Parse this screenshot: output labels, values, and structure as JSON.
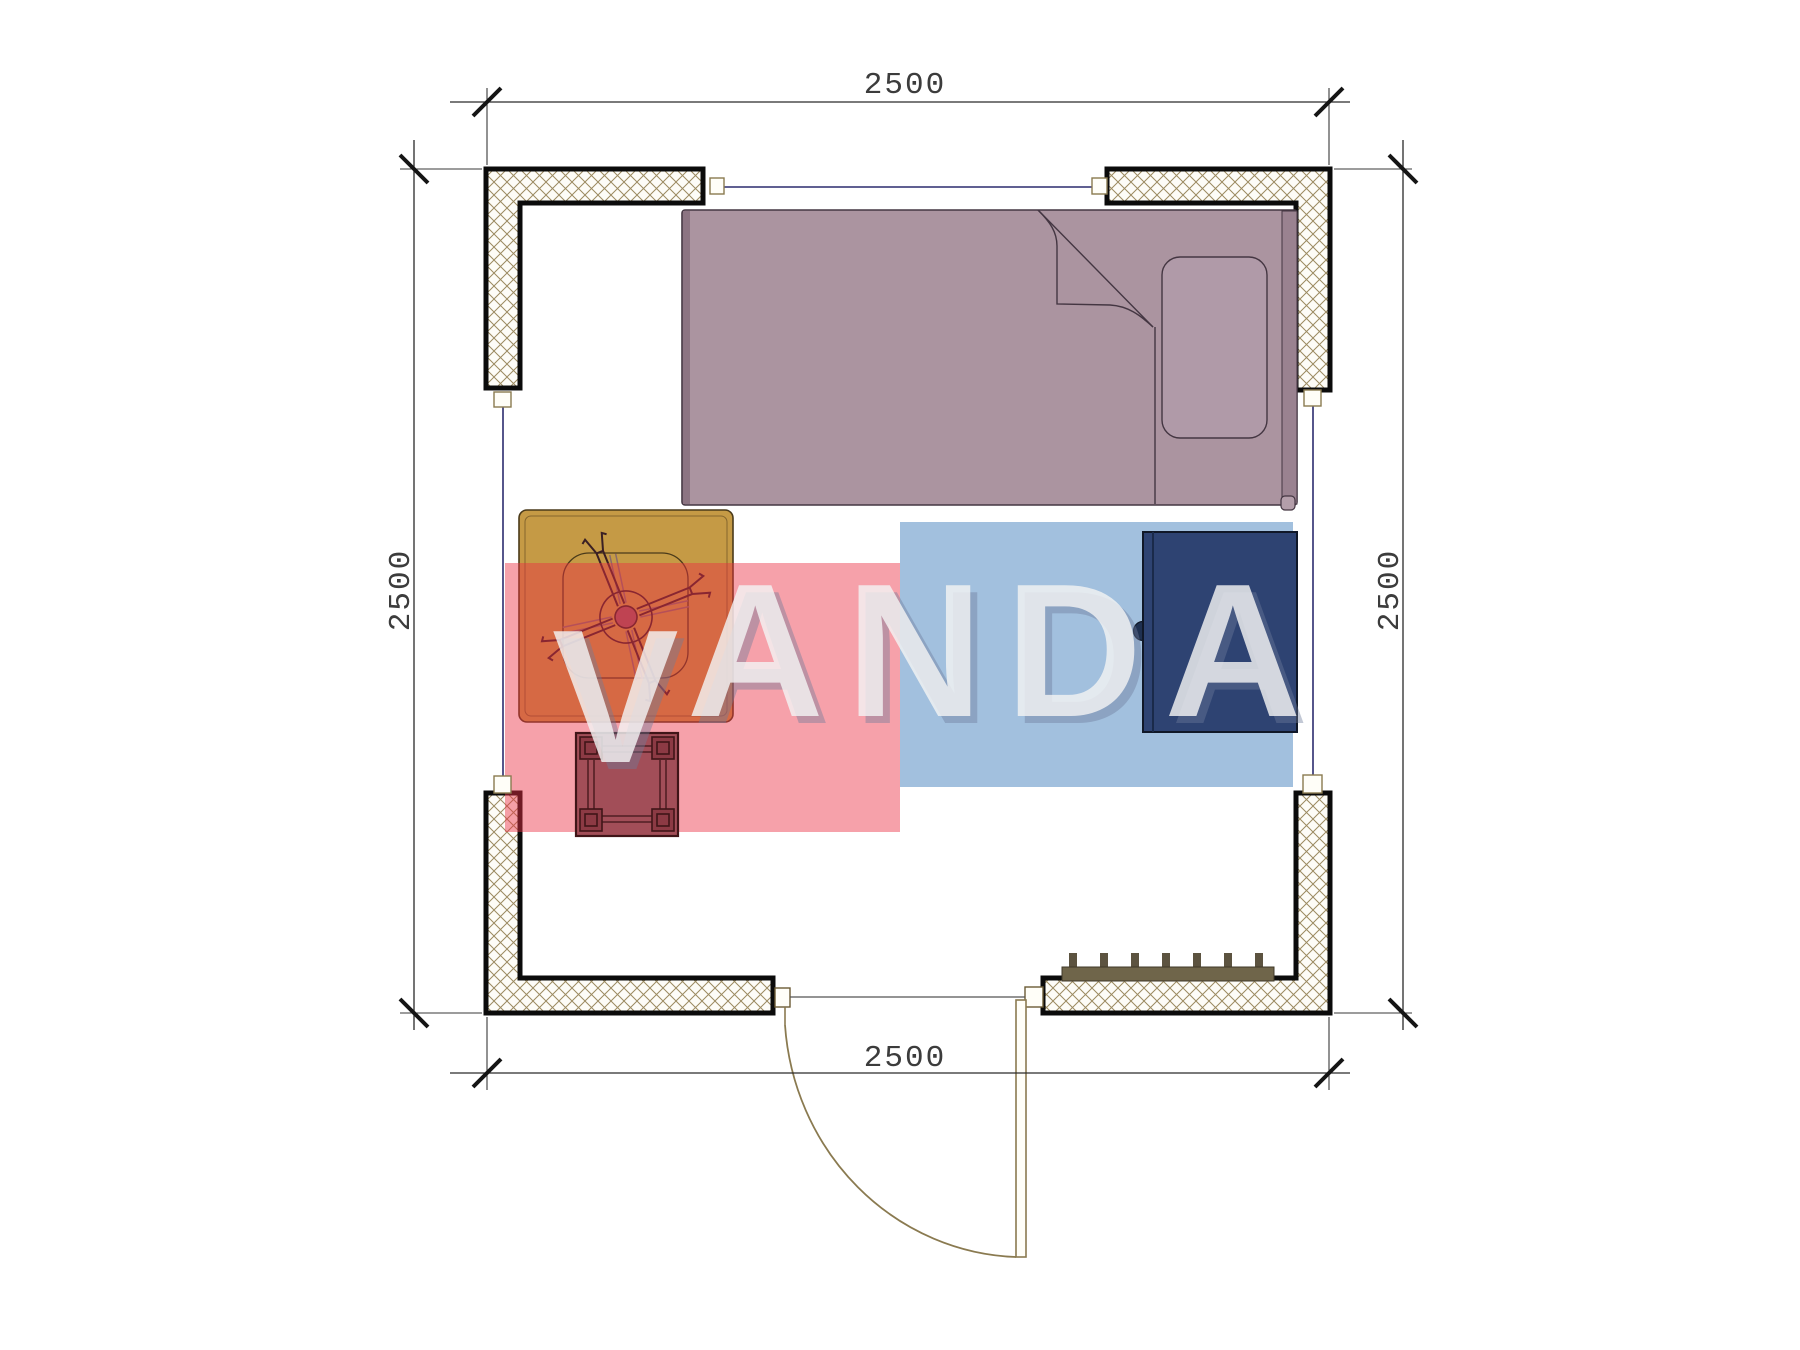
{
  "page": {
    "background": "#ffffff"
  },
  "plan": {
    "dimension_top": "2500",
    "dimension_bottom": "2500",
    "dimension_left": "2500",
    "dimension_right": "2500"
  },
  "watermark": {
    "letter_v": "V",
    "letters_rest": "ANDA",
    "letter_color": "rgba(243,243,243,0.82)",
    "letter_shadow_color": "rgba(110,125,155,0.42)",
    "red_block_color": "rgba(236,47,66,0.45)",
    "blue_block_color": "rgba(100,150,200,0.60)"
  },
  "furniture": {
    "bed_color": "#ab94a0",
    "bed_trim_color": "#8c7482",
    "bed_headboard_color": "#9a8290",
    "pillow_color": "#b09aa8",
    "table_color": "#c59a45",
    "stool_color": "#a24e58",
    "stool_post_color": "#8c3a44",
    "wardrobe_color": "#2e4372",
    "wardrobe_knob_color": "#1f3050",
    "radiator_color": "#6f654a",
    "radiator_fin_color": "#5c5340"
  },
  "drawing": {
    "wall_hatch_color": "#9b8a60",
    "wall_fill_color": "#fdfcf7",
    "window_line_color": "#2c2c6e",
    "door_line_color": "#8a7a50",
    "dimension_line_color": "#2a2a2a"
  }
}
